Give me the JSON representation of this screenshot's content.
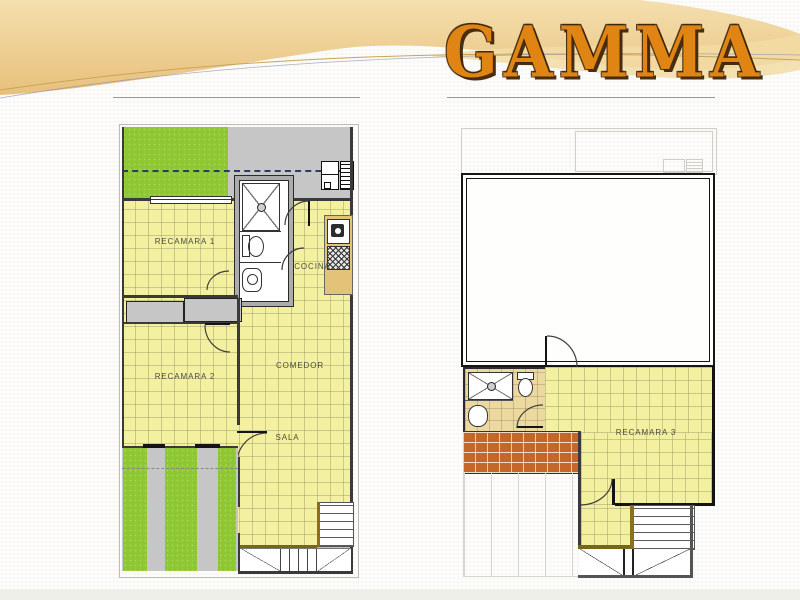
{
  "title": "GAMMA",
  "left_plan": {
    "name": "ground-floor-plan",
    "rooms": {
      "recamara1": "RECAMARA 1",
      "cocina": "COCINA",
      "recamara2": "RECAMARA 2",
      "comedor": "COMEDOR",
      "sala": "SALA"
    }
  },
  "right_plan": {
    "name": "upper-floor-plan",
    "rooms": {
      "recamara3": "RECAMARA 3"
    }
  },
  "colors": {
    "accent_orange": "#E08414",
    "title_outline_brown": "#3E2508",
    "tile_yellow": "#F3F0A0",
    "grass_green": "#8DC832",
    "concrete_gray": "#C6C6C6",
    "brick_orange": "#C5672A",
    "counter_tan": "#E2C377",
    "bath_tile_tan": "#EBD99F",
    "wall_dark": "#2A2A2A",
    "header_tan": "#EDCB8B"
  },
  "icons": {
    "fridge-icon": "outlined-rect",
    "vent-icon": "lined-rect",
    "shower-icon": "x-box-with-drain",
    "toilet-icon": "tank-and-bowl",
    "sink-icon": "round-basin",
    "kitchen-sink-icon": "basin-box",
    "stove-icon": "crosshatch-box",
    "window-icon": "double-line",
    "door-arc-icon": "quarter-circle",
    "stairs-icon": "lined-steps"
  }
}
